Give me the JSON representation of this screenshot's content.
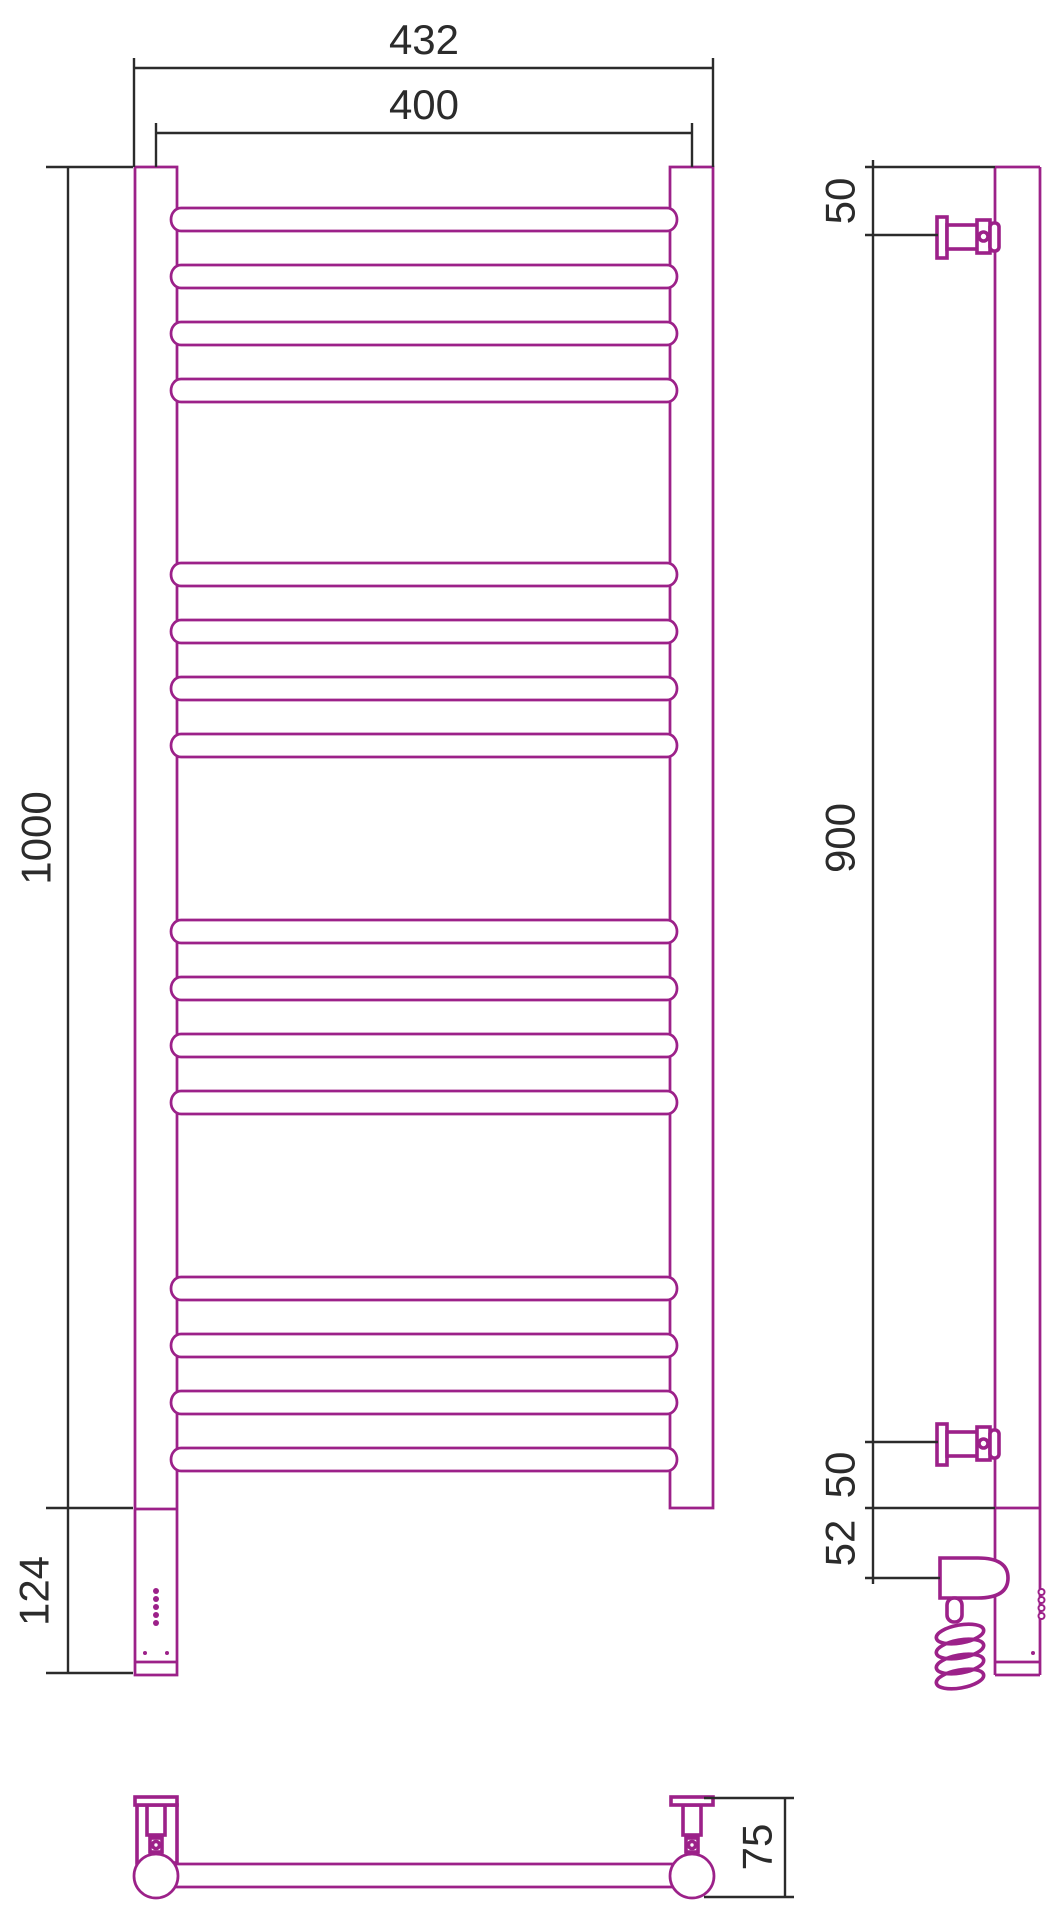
{
  "drawing": {
    "title": "towel-radiator-technical-drawing",
    "colors": {
      "outline": "#9C2189",
      "dimension": "#2B2B2B",
      "background": "#FFFFFF"
    },
    "views": {
      "front": "front-view",
      "side": "side-view",
      "bottom": "bottom-view"
    },
    "dims": {
      "overall_width": "432",
      "rail_pitch": "400",
      "height": "1000",
      "element_section": "124",
      "top_bracket_offset": "50",
      "bracket_span": "900",
      "bottom_bracket_offset": "50",
      "element_axis_offset": "52",
      "depth": "75"
    },
    "rungs": {
      "count": 16,
      "groups": 4,
      "per_group": 4
    },
    "led_dots": 5
  }
}
